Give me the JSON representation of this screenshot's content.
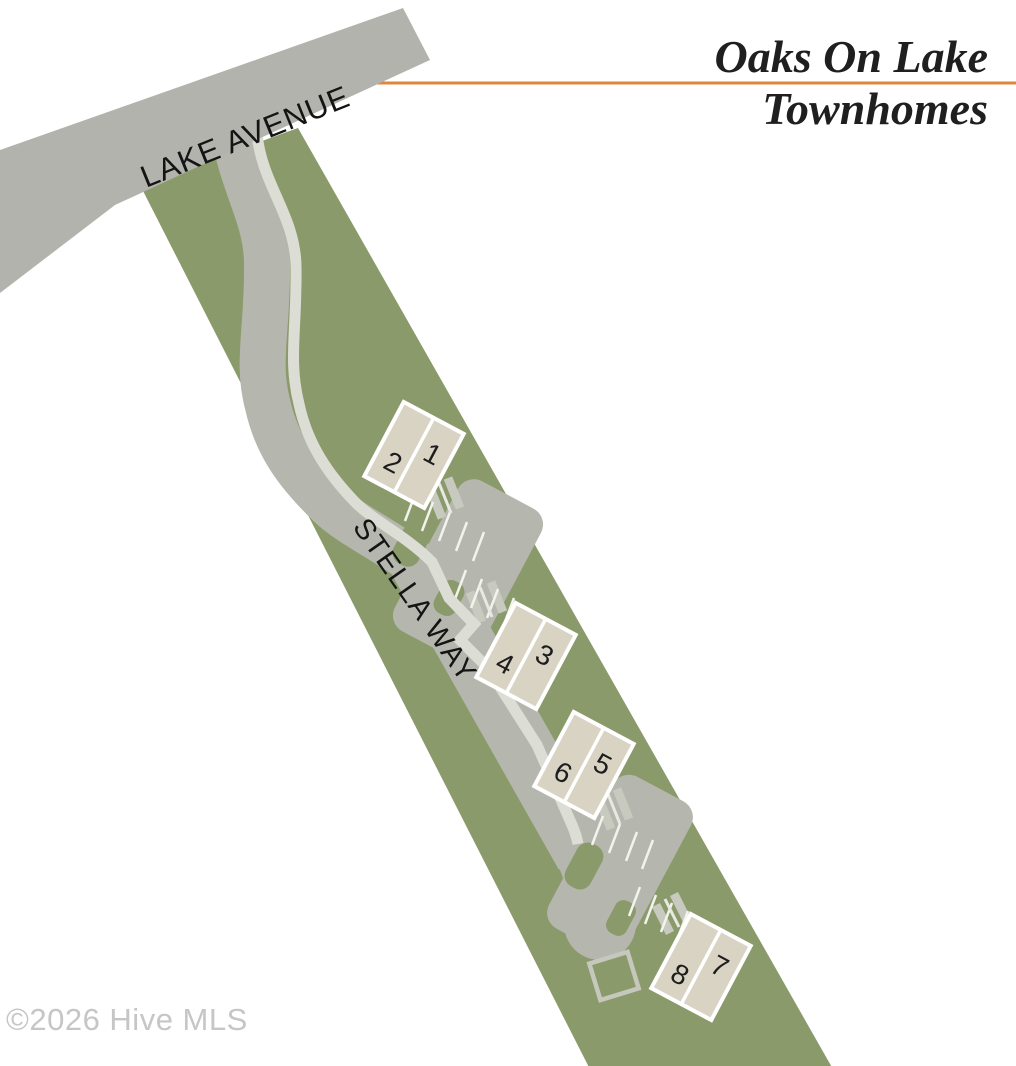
{
  "title": {
    "line1": "Oaks On Lake",
    "line2": "Townhomes"
  },
  "streets": {
    "lake_avenue": "LAKE AVENUE",
    "stella_way": "STELLA WAY"
  },
  "buildings": [
    {
      "id": "building-1-2",
      "units": [
        "1",
        "2"
      ]
    },
    {
      "id": "building-3-4",
      "units": [
        "3",
        "4"
      ]
    },
    {
      "id": "building-5-6",
      "units": [
        "5",
        "6"
      ]
    },
    {
      "id": "building-7-8",
      "units": [
        "7",
        "8"
      ]
    }
  ],
  "footer": {
    "copyright": "©2026 Hive MLS"
  },
  "colors": {
    "parcel_green": "#8B9A6A",
    "road_gray": "#B5B7AE",
    "lake_avenue_gray": "#B2B3AC",
    "driveway_gray": "#C8CABF",
    "sidewalk_gray": "#DCDED6",
    "stripe_white": "#F2F3EC",
    "building_fill": "#D8D3C3",
    "building_border": "#FFFFFF",
    "accent_orange": "#E0863C",
    "title_color": "#1F1F1F",
    "copyright_gray": "#C6C6C6"
  }
}
